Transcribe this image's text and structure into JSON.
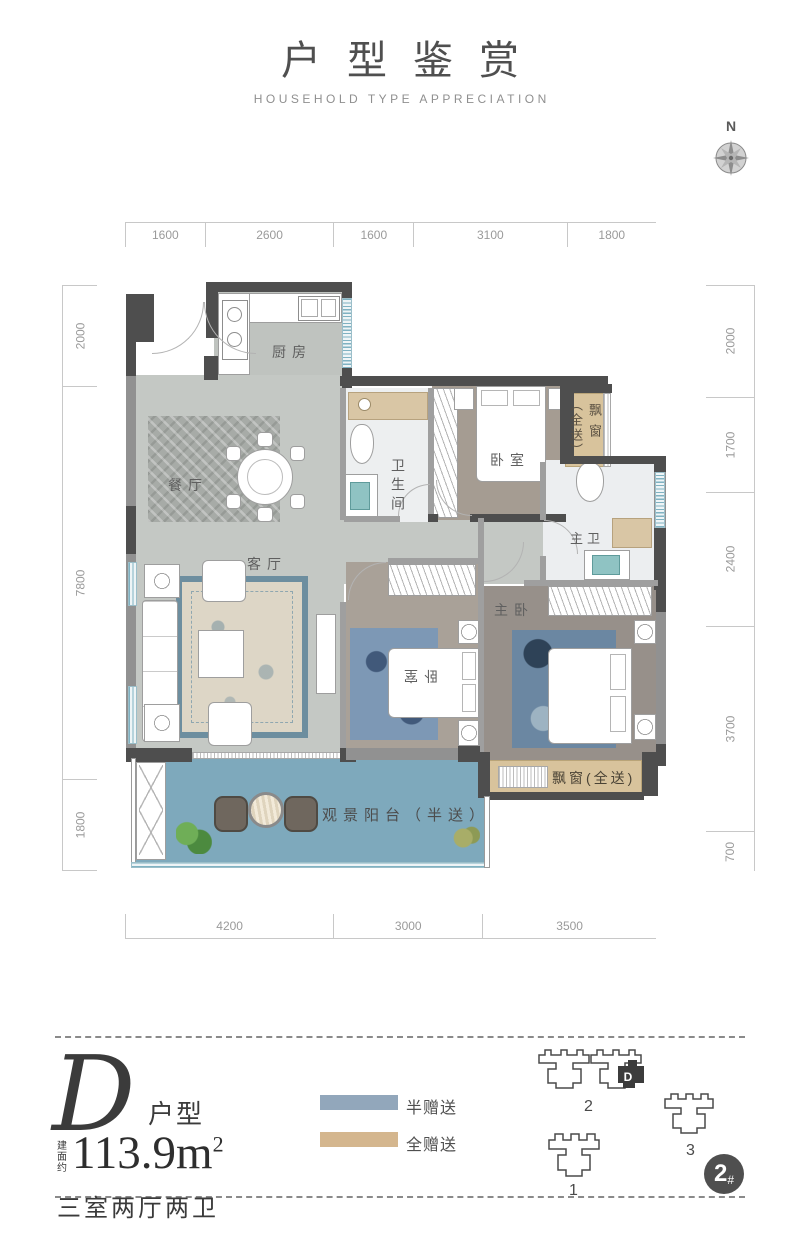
{
  "header": {
    "title": "户型鉴赏",
    "subtitle": "HOUSEHOLD TYPE APPRECIATION"
  },
  "compass": {
    "north": "N"
  },
  "dimensions": {
    "top": [
      "1600",
      "2600",
      "1600",
      "3100",
      "1800"
    ],
    "left": [
      "2000",
      "7800",
      "1800"
    ],
    "right": [
      "2000",
      "1700",
      "2400",
      "3700",
      "700"
    ],
    "bottom": [
      "4200",
      "3000",
      "3500"
    ]
  },
  "rooms": {
    "kitchen": "厨房",
    "dining": "餐厅",
    "living": "客厅",
    "bathroom": "卫生间",
    "bedroom_top": "卧室",
    "bedroom_second": "卧室",
    "master_bedroom": "主卧",
    "master_bath": "主卫",
    "balcony": "观景阳台（半送）",
    "bay_window_side_note": "（全送）",
    "bay_window_side_label": "飘窗",
    "bay_window_bottom": "飘窗(全送)"
  },
  "info": {
    "unit_letter": "D",
    "unit_suffix": "户型",
    "area_prefix": "建面约",
    "area_value": "113.9m",
    "area_sup": "2",
    "layout_desc": "三室两厅两卫"
  },
  "legend": {
    "items": [
      {
        "label": "半赠送",
        "color": "#92a7bb"
      },
      {
        "label": "全赠送",
        "color": "#d4b68e"
      }
    ]
  },
  "siteplan": {
    "building1": "1",
    "building2": "2",
    "building3": "3",
    "unit_marker": "D",
    "badge_num": "2",
    "badge_hash": "#"
  },
  "colors": {
    "wall": "#4e4e4e",
    "floor_grey": "#c4c8c4",
    "wood_floor": "#a59c92",
    "balcony_blue": "#7ea9bc",
    "bay_window_tan": "#d8c39c",
    "half_gift": "#92a7bb",
    "full_gift": "#d4b68e"
  }
}
